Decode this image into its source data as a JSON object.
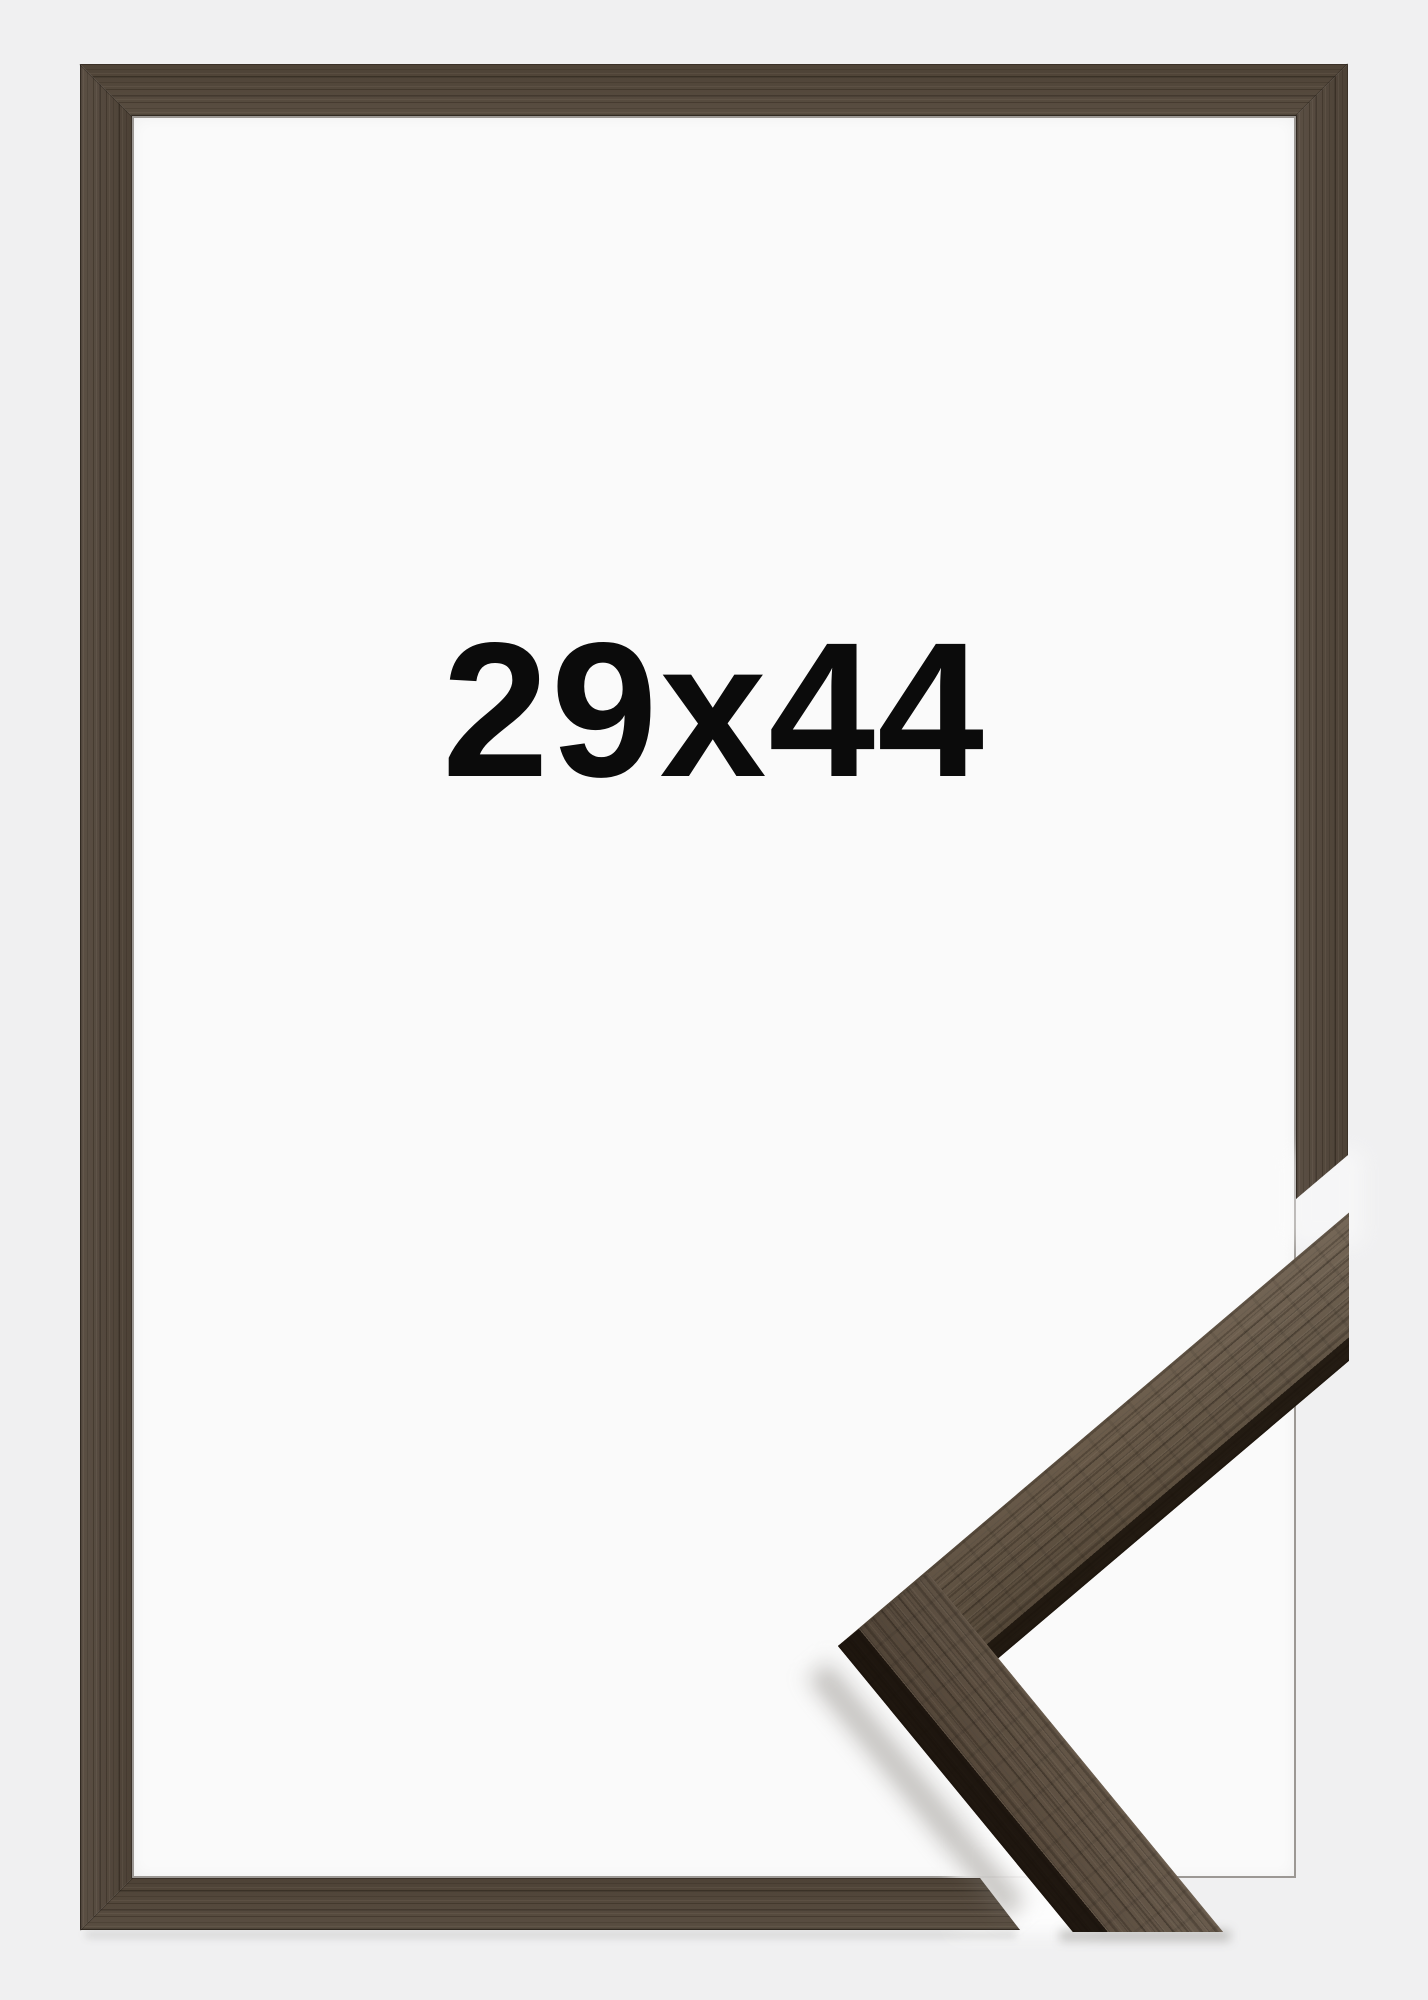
{
  "product_photo": {
    "size_label": "29x44",
    "colors": {
      "background": "#f0f0f1",
      "frame_interior": "#fafafa",
      "frame_wood": "#52463a",
      "wood_edge_dark": "#362e24",
      "label_text": "#0b0b0b"
    }
  }
}
